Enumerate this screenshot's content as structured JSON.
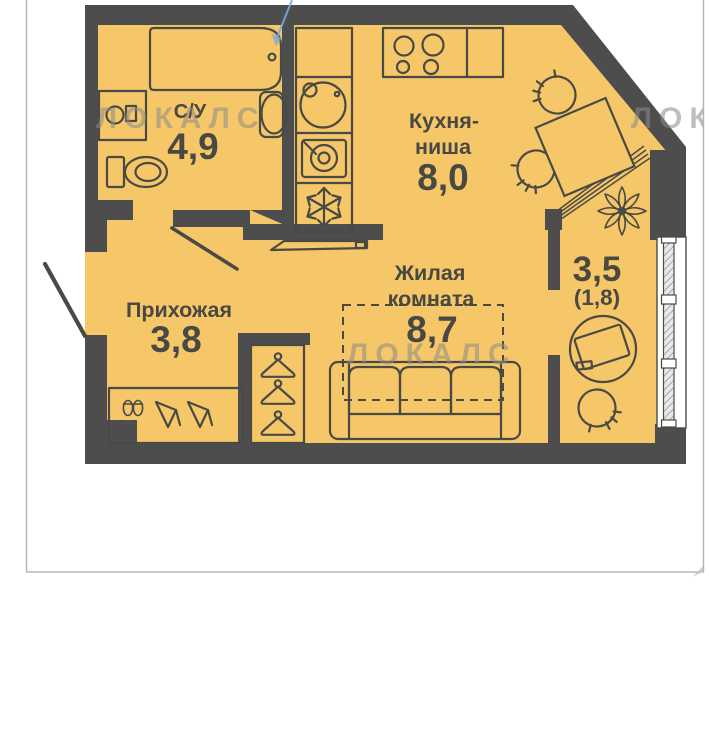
{
  "watermark": {
    "text": "ЛОКАЛС"
  },
  "plan": {
    "colors": {
      "floor": "#F5C768",
      "wall": "#4D4D4D",
      "lines": "#4A4A45",
      "annotation_blue": "#7FA8D9",
      "frame_border": "#B3B3B3",
      "watermark_grey": "#8C8C8C"
    },
    "rooms": {
      "bathroom": {
        "label": "С/У",
        "area": "4,9"
      },
      "kitchen": {
        "label_line1": "Кухня-",
        "label_line2": "ниша",
        "area": "8,0"
      },
      "living": {
        "label_line1": "Жилая",
        "label_line2": "комната",
        "area": "8,7"
      },
      "hallway": {
        "label": "Прихожая",
        "area": "3,8"
      },
      "balcony": {
        "area": "3,5",
        "area_secondary": "(1,8)"
      }
    }
  }
}
